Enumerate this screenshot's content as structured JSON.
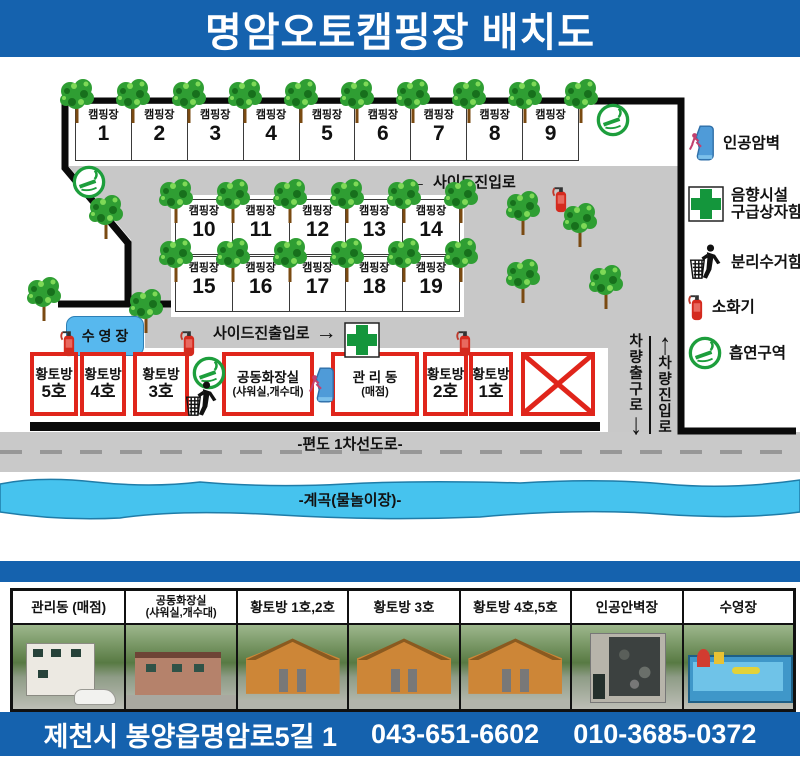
{
  "title": "명암오토캠핑장 배치도",
  "colors": {
    "primary_blue": "#1562ae",
    "road_gray": "#c8c8c8",
    "river_blue": "#46c3ee",
    "box_red": "#e0251b",
    "tree_green": "#2f9e33",
    "cross_green": "#14963c",
    "pool_blue": "#57b8ee"
  },
  "map": {
    "camp_label": "캠핑장",
    "camp_rows": [
      [
        "1",
        "2",
        "3",
        "4",
        "5",
        "6",
        "7",
        "8",
        "9"
      ],
      [
        "10",
        "11",
        "12",
        "13",
        "14"
      ],
      [
        "15",
        "16",
        "17",
        "18",
        "19"
      ]
    ],
    "pool_label": "수 영 장",
    "side_entry": {
      "arrow": "←",
      "label": "사이드진입로"
    },
    "side_exit": {
      "label": "사이드진출입로",
      "arrow": "→"
    },
    "vehicle_exit": {
      "label": "차량출구로",
      "arrow": "↓"
    },
    "vehicle_entry": {
      "label": "차량진입로",
      "arrow": "↑"
    },
    "main_road": "-편도 1차선도로-",
    "river": "-계곡(물놀이장)-",
    "buildings": [
      {
        "line1": "황토방",
        "line2": "5호"
      },
      {
        "line1": "황토방",
        "line2": "4호"
      },
      {
        "line1": "황토방",
        "line2": "3호"
      },
      {
        "line1": "공동화장실",
        "line2": "(샤워실,개수대)"
      },
      {
        "line1": "관 리 동",
        "line2": "(매점)"
      },
      {
        "line1": "황토방",
        "line2": "2호"
      },
      {
        "line1": "황토방",
        "line2": "1호"
      }
    ]
  },
  "legend": [
    {
      "icon": "climbing-wall-icon",
      "lines": [
        "인공암벽"
      ]
    },
    {
      "icon": "first-aid-icon",
      "lines": [
        "음향시설",
        "구급상자함"
      ]
    },
    {
      "icon": "recycle-icon",
      "lines": [
        "분리수거함"
      ]
    },
    {
      "icon": "fire-extinguisher-icon",
      "lines": [
        "소화기"
      ]
    },
    {
      "icon": "smoking-area-icon",
      "lines": [
        "흡연구역"
      ]
    }
  ],
  "photos": [
    {
      "label_lines": [
        "관리동 (매점)"
      ],
      "scene": "management-building-photo"
    },
    {
      "label_lines": [
        "공동화장실",
        "(샤워실,개수대)"
      ],
      "scene": "toilet-building-photo"
    },
    {
      "label_lines": [
        "황토방 1호,2호"
      ],
      "scene": "hwangto-room-photo"
    },
    {
      "label_lines": [
        "황토방 3호"
      ],
      "scene": "hwangto-room-photo"
    },
    {
      "label_lines": [
        "황토방 4호,5호"
      ],
      "scene": "hwangto-room-photo"
    },
    {
      "label_lines": [
        "인공안벽장"
      ],
      "scene": "climbing-wall-photo"
    },
    {
      "label_lines": [
        "수영장"
      ],
      "scene": "pool-photo"
    }
  ],
  "footer": {
    "address": "제천시 봉양읍명암로5길 1",
    "phone1": "043-651-6602",
    "phone2": "010-3685-0372"
  }
}
